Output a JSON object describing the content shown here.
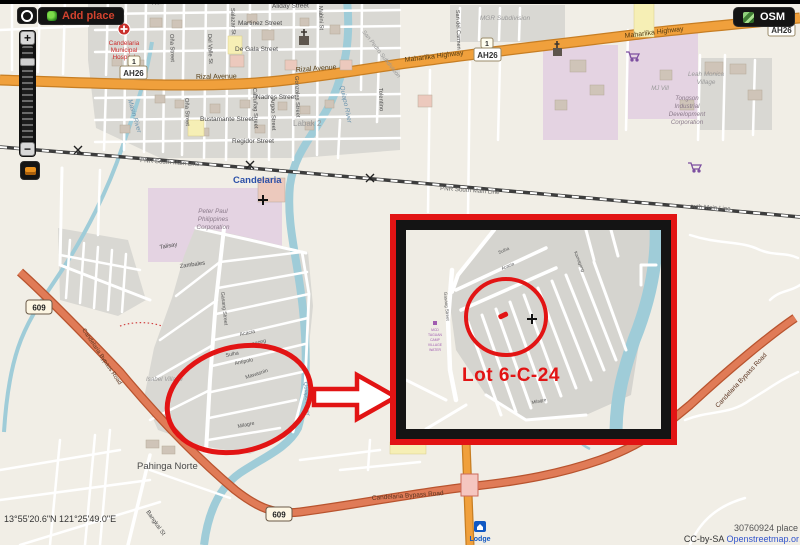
{
  "chrome": {
    "add_place": "Add place",
    "osm": "OSM",
    "coordinates": "13°55'20.6\"N 121°25'49.0\"E",
    "place_info": "30760924 place",
    "cc": "CC-by-SA",
    "osm_link": "Openstreetmap.or"
  },
  "annotation": {
    "lot": "Lot 6-C-24"
  },
  "shields": {
    "route1": "1",
    "ah26": "AH26",
    "r609": "609"
  },
  "labels": {
    "norte": "Norte",
    "aliday": "Aliday Street",
    "martinez": "Martinez Street",
    "de_gala": "De Gala Street",
    "salazar": "Salazar St",
    "del_valle": "Del Valle St",
    "ona": "Oña Street",
    "nadres": "Nadres Street",
    "bustamante": "Bustamante Street",
    "regidor": "Regidor Street",
    "argao": "Argao Street",
    "gonzales": "Gonzales Street",
    "cabunag": "Cabuñag Street",
    "mabini": "Mabini St",
    "tolentino": "Tolentino",
    "san_del_carmen": "San del Carmen",
    "san_pedro": "San Pedro Subdivision",
    "labak": "Labak 2",
    "quiapo_river": "Quiapo River",
    "masin_river": "Masin River",
    "rizal_avenue": "Rizal Avenue",
    "maharlika_highway": "Maharlika Highway",
    "pnr": "PNR South Main Line",
    "south_main_line": "outh Main Line",
    "candelaria": "Candelaria",
    "hospital1": "Candelaria",
    "hospital2": "Municipal",
    "hospital3": "Hospital",
    "peter_paul1": "Peter Paul",
    "peter_paul2": "Philippines",
    "peter_paul3": "Corporation",
    "mgr": "MGR Subdivision",
    "dona1": "Doña Margarita",
    "dona2": "Subdivision",
    "leah1": "Leah Monica",
    "leah2": "Village",
    "mj_vill": "MJ Vill",
    "tongson1": "Tongson",
    "tongson2": "Industrial",
    "tongson3": "Development",
    "tongson4": "Corporation",
    "isabel": "Isabel Village",
    "pahinga": "Pahinga Norte",
    "talisay": "Talisay",
    "zambales": "Zambales",
    "acacia": "Acacia",
    "kamagong": "Kamagong",
    "sulha": "Sulha",
    "antipolo": "Antipolo",
    "mawasnin": "Mawasnin",
    "milagre": "Milagre",
    "gasang": "Gasang Street",
    "bangkal": "Bangkal St",
    "bypass": "Candelaria Bypass Road",
    "lodge": "Lodge"
  },
  "inset": {
    "note_lines": [
      "MCD",
      "TAGUAN",
      "CAMP",
      "VILLAGE",
      "WATER"
    ]
  },
  "colors": {
    "annotation_red": "#e21414",
    "road_orange": "#f0a03c",
    "bypass_salmon": "#e07b57",
    "river_teal": "#9fccd8"
  }
}
